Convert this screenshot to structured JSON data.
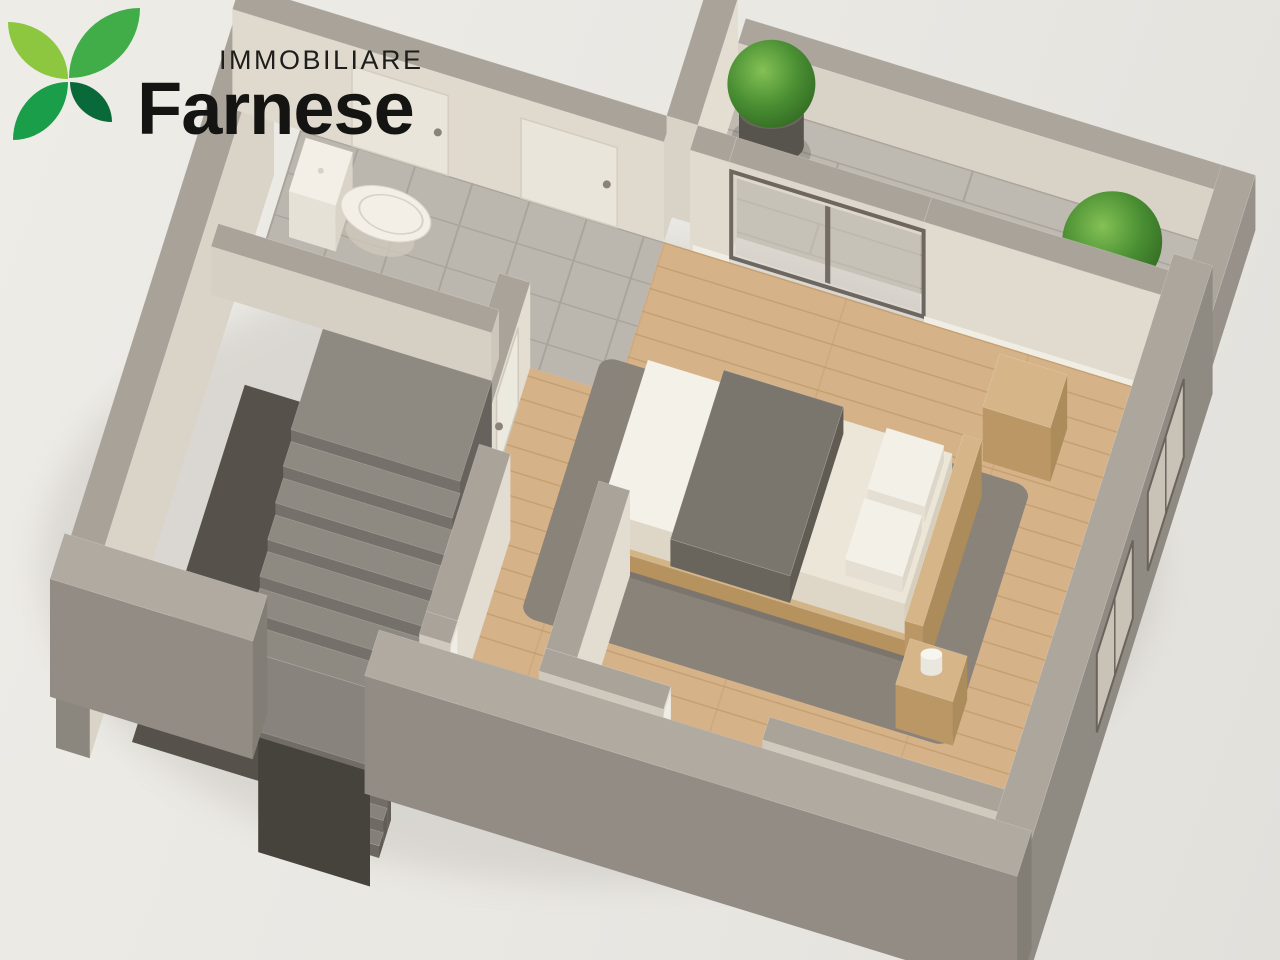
{
  "logo": {
    "line1": "IMMOBILIARE",
    "line2": "Farnese",
    "leaf_colors": [
      "#8dc63f",
      "#41ad49",
      "#1a9e4a",
      "#0a6938"
    ]
  },
  "palette": {
    "background_top": "#eeece7",
    "background_bottom": "#e2e0db",
    "wall_top": "#a9a39a",
    "wall_cream": "#e0dacf",
    "wall_exterior": "#8f8a82",
    "wood_base": "#d6b288",
    "wood_line": "#c29c6e",
    "tile_base": "#bcb7ae",
    "tile_line": "#a9a49b",
    "paver_base": "#bfbab1",
    "paver_line": "#aaa49b",
    "plant_green": "#4a8f33",
    "pot_gray": "#57534d",
    "text_dark": "#141412"
  },
  "scene": {
    "m": [
      1.3,
      0.4,
      -0.3,
      0.95,
      300,
      130
    ],
    "items": [
      {
        "k": "se",
        "n": "ground-shadow",
        "cx": 600,
        "cy": 565,
        "rx": 560,
        "ry": 320,
        "f": "#8b867e",
        "o": 0.18
      },
      {
        "k": "fl",
        "n": "terrace-paver-floor",
        "z": 0,
        "sh": {
          "t": "rect",
          "x": 300,
          "y": -160,
          "w": 366,
          "h": 134
        },
        "f": "url(#pat-pav)"
      },
      {
        "k": "fl",
        "n": "bathroom-tile-floor",
        "z": 0,
        "sh": {
          "t": "rect",
          "x": 0,
          "y": 0,
          "w": 280,
          "h": 160
        },
        "f": "url(#pat-tile)"
      },
      {
        "k": "fl",
        "n": "bedroom-wood-floor",
        "z": 0,
        "sh": {
          "t": "path",
          "d": "M190 160H666V560H190Z M280 0H666V160H280Z"
        },
        "f": "url(#pat-wood)"
      },
      {
        "k": "box",
        "n": "west-exterior-wall",
        "x": -52,
        "y": -26,
        "w": 26,
        "d": 614,
        "z": -80,
        "h": 165,
        "ct": "#a8a299",
        "cs": "#8b867e",
        "ce": "#d9d3c8"
      },
      {
        "k": "box",
        "n": "bathroom-north-wall",
        "x": -52,
        "y": -26,
        "w": 332,
        "d": 26,
        "z": 0,
        "h": 100,
        "ct": "#a9a39a",
        "cs": "#dfd9ce",
        "ce": "#d8d2c7"
      },
      {
        "k": "vq",
        "n": "entry-door-1",
        "x1": 40,
        "y1": 0,
        "x2": 114,
        "y2": 0,
        "z1": 0,
        "z2": 80,
        "f": "#eae5da",
        "st": "#d3ccc0",
        "sw": 1.5
      },
      {
        "k": "dot",
        "n": "door-handle-1",
        "x": 106,
        "y": 0,
        "z": 40,
        "r": 4,
        "f": "#8a8379"
      },
      {
        "k": "vq",
        "n": "entry-door-2",
        "x1": 170,
        "y1": 0,
        "x2": 244,
        "y2": 0,
        "z1": 0,
        "z2": 80,
        "f": "#eae5da",
        "st": "#d3ccc0",
        "sw": 1.5
      },
      {
        "k": "dot",
        "n": "door-handle-2",
        "x": 236,
        "y": 0,
        "z": 40,
        "r": 4,
        "f": "#8a8379"
      },
      {
        "k": "box",
        "n": "terrace-west-wall",
        "x": 276,
        "y": -160,
        "w": 24,
        "d": 134,
        "z": 0,
        "h": 100,
        "ct": "#a9a39a",
        "cs": "#d8d2c7",
        "ce": "#e3ddd2"
      },
      {
        "k": "box",
        "n": "terrace-north-parapet",
        "x": 300,
        "y": -186,
        "w": 392,
        "d": 26,
        "z": 0,
        "h": 55,
        "ct": "#aba59c",
        "cs": "#d8d2c7",
        "ce": "#cfc9be"
      },
      {
        "k": "box",
        "n": "terrace-east-parapet",
        "x": 666,
        "y": -186,
        "w": 26,
        "d": 160,
        "z": 0,
        "h": 55,
        "ct": "#aba59c",
        "cs": "#cfc9be",
        "ce": "#97918a"
      },
      {
        "k": "fl",
        "n": "plant-shadow-1",
        "z": 1,
        "sh": {
          "t": "ell",
          "cx": 334,
          "cy": -124,
          "rx": 30,
          "ry": 21
        },
        "f": "#000000",
        "o": 0.15
      },
      {
        "k": "cyl",
        "n": "plant-pot-1",
        "cx": 334,
        "cy": -124,
        "r": 24,
        "z": 0,
        "h": 34,
        "cb": "#57534d",
        "ctp": "#6a665f"
      },
      {
        "k": "sp",
        "n": "plant-bush-1",
        "cx": 334,
        "cy": -124,
        "z": 62,
        "r": 44,
        "f": "url(#gbush)"
      },
      {
        "k": "fl",
        "n": "plant-shadow-2",
        "z": 1,
        "sh": {
          "t": "ell",
          "cx": 610,
          "cy": -64,
          "rx": 34,
          "ry": 24
        },
        "f": "#000000",
        "o": 0.15
      },
      {
        "k": "cyl",
        "n": "plant-pot-2",
        "cx": 610,
        "cy": -64,
        "r": 28,
        "z": 0,
        "h": 38,
        "cb": "#55514b",
        "ctp": "#68645d"
      },
      {
        "k": "sp",
        "n": "plant-bush-2",
        "cx": 610,
        "cy": -64,
        "z": 72,
        "r": 50,
        "f": "url(#gbush)"
      },
      {
        "k": "vq",
        "n": "french-window-glazing",
        "x1": 334,
        "y1": -4,
        "x2": 476,
        "y2": -4,
        "z1": 5,
        "z2": 85,
        "f": "#cfcabf",
        "o": 0.5
      },
      {
        "k": "vq",
        "n": "french-window-mullion",
        "x1": 403,
        "y1": -4,
        "x2": 407,
        "y2": -4,
        "z1": 5,
        "z2": 85,
        "f": "#6e675f",
        "o": 0.95
      },
      {
        "k": "box",
        "n": "bedroom-north-wall-west",
        "x": 300,
        "y": -26,
        "w": 30,
        "d": 26,
        "z": 0,
        "h": 100,
        "ct": "#a9a39a",
        "cs": "#e0dacf",
        "ce": "#d8d2c7"
      },
      {
        "k": "box",
        "n": "window-lintel",
        "x": 330,
        "y": -26,
        "w": 150,
        "d": 26,
        "z": 86,
        "h": 14,
        "ct": "#a9a39a",
        "cs": "#ddd7cc",
        "ce": "#d4cec3"
      },
      {
        "k": "box",
        "n": "bedroom-north-wall-east",
        "x": 480,
        "y": -26,
        "w": 186,
        "d": 26,
        "z": 0,
        "h": 100,
        "ct": "#a9a39a",
        "cs": "#e0dacf",
        "ce": "#d8d2c7"
      },
      {
        "k": "vq",
        "n": "french-window-frame",
        "x1": 331,
        "y1": -3,
        "x2": 479,
        "y2": -3,
        "z1": 2,
        "z2": 88,
        "st": "#6e675f",
        "sw": 4
      },
      {
        "k": "vq",
        "n": "baseboard-north-1",
        "x1": 302,
        "y1": 0,
        "x2": 330,
        "y2": 0,
        "z1": 0,
        "z2": 6,
        "f": "#f0ede4"
      },
      {
        "k": "vq",
        "n": "baseboard-north-2",
        "x1": 480,
        "y1": 0,
        "x2": 664,
        "y2": 0,
        "z1": 0,
        "z2": 6,
        "f": "#f0ede4"
      },
      {
        "k": "box",
        "n": "central-wall",
        "x": 190,
        "y": 160,
        "w": 24,
        "d": 170,
        "z": 0,
        "h": 85,
        "ct": "#a9a39a",
        "cs": "#cfc9be",
        "ce": "#e3ddd2"
      },
      {
        "k": "vq",
        "n": "bedroom-door",
        "x1": 214,
        "y1": 200,
        "x2": 214,
        "y2": 272,
        "z1": 0,
        "z2": 78,
        "f": "#eceade",
        "st": "#cfc8bb",
        "sw": 1.5
      },
      {
        "k": "dot",
        "n": "bedroom-door-handle",
        "x": 214,
        "y": 264,
        "z": 40,
        "r": 4,
        "f": "#8a8379"
      },
      {
        "k": "fl",
        "n": "toilet-pedestal",
        "z": 2,
        "sh": {
          "t": "ell",
          "cx": 80,
          "cy": 80,
          "rx": 26,
          "ry": 19
        },
        "f": "#cdc7bb",
        "o": 0.8
      },
      {
        "k": "box",
        "n": "toilet-cistern",
        "x": 16,
        "y": 50,
        "w": 36,
        "d": 56,
        "z": 0,
        "h": 46,
        "ct": "#f3efe7",
        "cs": "#e6e1d6",
        "ce": "#dad4c8"
      },
      {
        "k": "dot",
        "n": "toilet-flush-button",
        "x": 34,
        "y": 78,
        "z": 47,
        "r": 3,
        "f": "#d8d2c6"
      },
      {
        "k": "fl",
        "n": "toilet-bowl",
        "z": 24,
        "sh": {
          "t": "ell",
          "cx": 84,
          "cy": 78,
          "rx": 34,
          "ry": 26
        },
        "f": "#f3efe7",
        "st": "#dcd6cb",
        "sw": 1
      },
      {
        "k": "fl",
        "n": "toilet-seat",
        "z": 25,
        "sh": {
          "t": "ell",
          "cx": 88,
          "cy": 78,
          "rx": 24,
          "ry": 18
        },
        "f": "none",
        "st": "#d8d2c6",
        "sw": 1.5
      },
      {
        "k": "box",
        "n": "bathroom-half-wall",
        "x": -26,
        "y": 160,
        "w": 216,
        "d": 24,
        "z": 0,
        "h": 48,
        "ct": "#a9a39a",
        "cs": "#d5cfc4",
        "ce": "#ccc6bb"
      },
      {
        "k": "fl",
        "n": "stairwell-pit-floor",
        "z": -80,
        "sh": {
          "t": "rect",
          "x": 0,
          "y": 184,
          "w": 190,
          "h": 376
        },
        "f": "#56524b"
      },
      {
        "k": "box",
        "n": "stair-top-landing",
        "x": 60,
        "y": 184,
        "w": 130,
        "d": 106,
        "z": -80,
        "h": 80,
        "ct": "#8e8981",
        "cs": "#757069",
        "ce": "#67625c"
      },
      {
        "k": "box",
        "n": "stair-step-1",
        "x": 60,
        "y": 290,
        "w": 130,
        "d": 26,
        "z": -80,
        "h": 68,
        "ct": "#8e8981",
        "cs": "#757069",
        "ce": "#67625c"
      },
      {
        "k": "box",
        "n": "stair-step-2",
        "x": 60,
        "y": 316,
        "w": 130,
        "d": 26,
        "z": -80,
        "h": 56,
        "ct": "#8e8981",
        "cs": "#757069",
        "ce": "#67625c"
      },
      {
        "k": "box",
        "n": "stair-step-3",
        "x": 60,
        "y": 342,
        "w": 130,
        "d": 26,
        "z": -80,
        "h": 44,
        "ct": "#8e8981",
        "cs": "#757069",
        "ce": "#67625c"
      },
      {
        "k": "box",
        "n": "stair-step-4",
        "x": 60,
        "y": 368,
        "w": 130,
        "d": 26,
        "z": -80,
        "h": 32,
        "ct": "#8e8981",
        "cs": "#757069",
        "ce": "#67625c"
      },
      {
        "k": "box",
        "n": "stair-step-5",
        "x": 60,
        "y": 394,
        "w": 130,
        "d": 26,
        "z": -80,
        "h": 20,
        "ct": "#8e8981",
        "cs": "#757069",
        "ce": "#67625c"
      },
      {
        "k": "box",
        "n": "stair-step-6",
        "x": 60,
        "y": 420,
        "w": 130,
        "d": 26,
        "z": -80,
        "h": 8,
        "ct": "#8e8981",
        "cs": "#757069",
        "ce": "#67625c"
      },
      {
        "k": "box",
        "n": "stair-lower-landing",
        "x": 60,
        "y": 446,
        "w": 130,
        "d": 74,
        "z": -80,
        "h": 8,
        "ct": "#88837c",
        "cs": "#716c65",
        "ce": "#645f59"
      },
      {
        "k": "box",
        "n": "lower-step-1",
        "x": 104,
        "y": 520,
        "w": 86,
        "d": 13,
        "z": -120,
        "h": 36,
        "ct": "#8a857e",
        "cs": "#726d66",
        "ce": "#655f59"
      },
      {
        "k": "box",
        "n": "lower-step-2",
        "x": 104,
        "y": 533,
        "w": 86,
        "d": 13,
        "z": -120,
        "h": 24,
        "ct": "#87827b",
        "cs": "#6f6a63",
        "ce": "#625d57"
      },
      {
        "k": "box",
        "n": "lower-step-3",
        "x": 104,
        "y": 546,
        "w": 86,
        "d": 14,
        "z": -120,
        "h": 12,
        "ct": "#847f78",
        "cs": "#6c6760",
        "ce": "#5f5a54"
      },
      {
        "k": "vq",
        "n": "stair-shaft-back",
        "x1": 104,
        "y1": 590,
        "x2": 190,
        "y2": 590,
        "z1": -120,
        "z2": -5,
        "f": "#46423c"
      },
      {
        "k": "fl",
        "n": "area-rug",
        "z": 1,
        "sh": {
          "t": "rect",
          "x": 262,
          "y": 128,
          "w": 330,
          "h": 274,
          "rx": 12
        },
        "f": "#86817a",
        "o": 0.96
      },
      {
        "k": "fl",
        "n": "bed-shadow",
        "z": 2,
        "sh": {
          "t": "rect",
          "x": 296,
          "y": 156,
          "w": 253,
          "h": 178
        },
        "f": "#000000",
        "o": 0.1
      },
      {
        "k": "box",
        "n": "bed-platform",
        "x": 300,
        "y": 160,
        "w": 245,
        "d": 170,
        "z": 4,
        "h": 16,
        "ct": "#d3b487",
        "cs": "#b5925e",
        "ce": "#a88752"
      },
      {
        "k": "box",
        "n": "bed-mattress",
        "x": 306,
        "y": 166,
        "w": 234,
        "d": 158,
        "z": 20,
        "h": 30,
        "ct": "#ece6d9",
        "cs": "#ded7c7",
        "ce": "#d6cfbd"
      },
      {
        "k": "fl",
        "n": "bed-sheet-fold",
        "z": 50,
        "sh": {
          "t": "rect",
          "x": 306,
          "y": 166,
          "w": 58,
          "h": 158
        },
        "f": "#f4f1e9"
      },
      {
        "k": "box",
        "n": "bed-blanket",
        "x": 362,
        "y": 156,
        "w": 92,
        "d": 178,
        "z": 26,
        "h": 27,
        "ct": "#7b766d",
        "cs": "#6a655c",
        "ce": "#605b53"
      },
      {
        "k": "box",
        "n": "bed-pillow-1",
        "x": 492,
        "y": 176,
        "w": 44,
        "d": 64,
        "z": 50,
        "h": 16,
        "ct": "#f3f0e8",
        "cs": "#e4dfd2",
        "ce": "#ddd7c9"
      },
      {
        "k": "box",
        "n": "bed-pillow-2",
        "x": 492,
        "y": 250,
        "w": 44,
        "d": 64,
        "z": 50,
        "h": 16,
        "ct": "#f3f0e8",
        "cs": "#e4dfd2",
        "ce": "#ddd7c9"
      },
      {
        "k": "box",
        "n": "bed-headboard",
        "x": 545,
        "y": 150,
        "w": 14,
        "d": 196,
        "z": 0,
        "h": 56,
        "ct": "#d6b588",
        "cs": "#bb9765",
        "ce": "#ad8c5b"
      },
      {
        "k": "box",
        "n": "side-cabinet",
        "x": 552,
        "y": 60,
        "w": 52,
        "d": 56,
        "z": 0,
        "h": 54,
        "ct": "#d6b588",
        "cs": "#bb9765",
        "ce": "#ad8c5b"
      },
      {
        "k": "box",
        "n": "nightstand",
        "x": 550,
        "y": 350,
        "w": 44,
        "d": 48,
        "z": 0,
        "h": 44,
        "ct": "#d6b588",
        "cs": "#bb9765",
        "ce": "#ad8c5b"
      },
      {
        "k": "cyl",
        "n": "cup",
        "cx": 572,
        "cy": 374,
        "r": 8,
        "z": 44,
        "h": 16,
        "cb": "#eae7df",
        "ctp": "#f7f5f0"
      },
      {
        "k": "box",
        "n": "closet-wall-west",
        "x": 214,
        "y": 330,
        "w": 24,
        "d": 176,
        "z": 0,
        "h": 85,
        "ct": "#a9a39a",
        "cs": "#cfc9be",
        "ce": "#e2dcd1"
      },
      {
        "k": "box",
        "n": "closet-wall-east",
        "x": 306,
        "y": 330,
        "w": 24,
        "d": 176,
        "z": 0,
        "h": 85,
        "ct": "#a9a39a",
        "cs": "#cfc9be",
        "ce": "#e2dcd1"
      },
      {
        "k": "box",
        "n": "bottom-wall-a",
        "x": 214,
        "y": 506,
        "w": 24,
        "d": 24,
        "z": 0,
        "h": 85,
        "ct": "#a9a39a",
        "cs": "#cfc9be",
        "ce": "#e2dcd1"
      },
      {
        "k": "box",
        "n": "bottom-wall-b",
        "x": 306,
        "y": 506,
        "w": 96,
        "d": 24,
        "z": 0,
        "h": 85,
        "ct": "#a9a39a",
        "cs": "#cfc9be",
        "ce": "#e2dcd1"
      },
      {
        "k": "box",
        "n": "bottom-wall-c",
        "x": 478,
        "y": 506,
        "w": 188,
        "d": 24,
        "z": 0,
        "h": 85,
        "ct": "#a9a39a",
        "cs": "#cfc9be",
        "ce": "#e2dcd1"
      },
      {
        "k": "vq",
        "n": "doorway-jamb-1",
        "x1": 238,
        "y1": 506,
        "x2": 238,
        "y2": 530,
        "z1": 0,
        "z2": 80,
        "f": "#f0ede5"
      },
      {
        "k": "vq",
        "n": "doorway-jamb-2",
        "x1": 402,
        "y1": 506,
        "x2": 402,
        "y2": 530,
        "z1": 0,
        "z2": 80,
        "f": "#f0ede5"
      },
      {
        "k": "box",
        "n": "east-exterior-wall",
        "x": 666,
        "y": -26,
        "w": 30,
        "d": 614,
        "z": -10,
        "h": 128,
        "ct": "#aca69d",
        "cs": "#837e76",
        "ce": "#8f8a82"
      },
      {
        "k": "vq",
        "n": "east-window-cut-1",
        "x1": 696,
        "y1": 70,
        "x2": 696,
        "y2": 190,
        "z1": 18,
        "z2": 96,
        "f": "#c8c2b7",
        "st": "#6b645d",
        "sw": 2
      },
      {
        "k": "vq",
        "n": "east-window-mullion-1",
        "x1": 696,
        "y1": 130,
        "x2": 696,
        "y2": 130,
        "z1": 18,
        "z2": 96,
        "st": "#6b645d",
        "sw": 1.5
      },
      {
        "k": "vq",
        "n": "east-window-cut-2",
        "x1": 696,
        "y1": 240,
        "x2": 696,
        "y2": 360,
        "z1": 18,
        "z2": 96,
        "f": "#c8c2b7",
        "st": "#6b645d",
        "sw": 2
      },
      {
        "k": "vq",
        "n": "east-window-mullion-2",
        "x1": 696,
        "y1": 300,
        "x2": 696,
        "y2": 300,
        "z1": 18,
        "z2": 96,
        "st": "#6b645d",
        "sw": 1.5
      },
      {
        "k": "box",
        "n": "south-exterior-wall-west",
        "x": -52,
        "y": 560,
        "w": 156,
        "d": 48,
        "z": -10,
        "h": 118,
        "ct": "#b0aaa1",
        "cs": "#928c84",
        "ce": "#827d75"
      },
      {
        "k": "box",
        "n": "south-exterior-wall-east",
        "x": 190,
        "y": 560,
        "w": 502,
        "d": 48,
        "z": -10,
        "h": 118,
        "ct": "#b0aaa1",
        "cs": "#928c84",
        "ce": "#827d75"
      }
    ]
  }
}
